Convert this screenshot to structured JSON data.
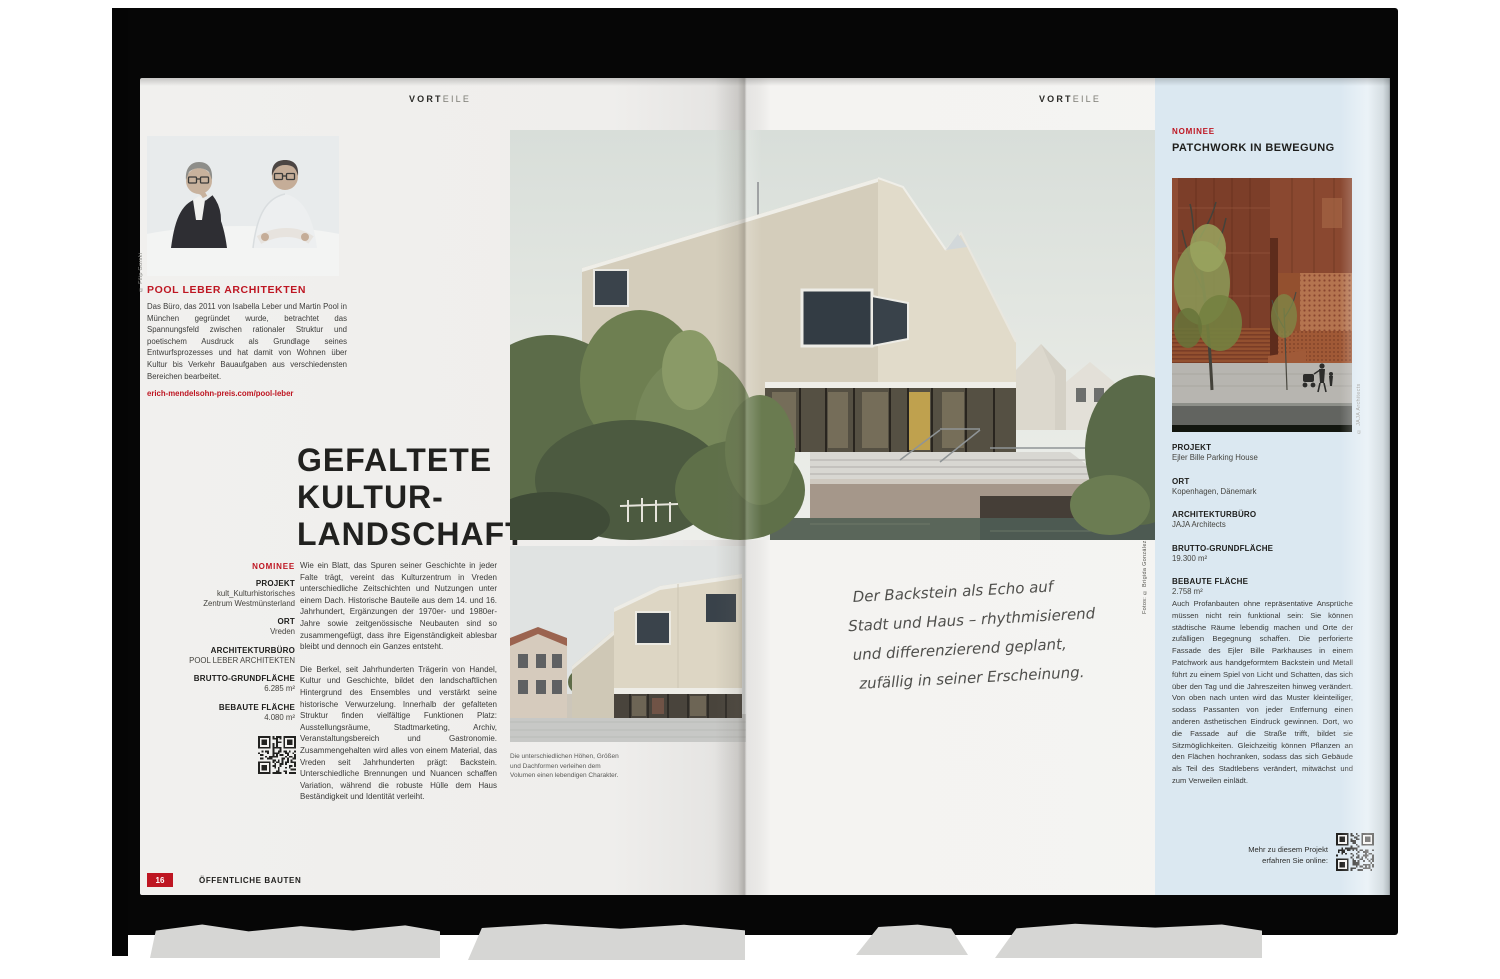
{
  "colors": {
    "accent_red": "#be1622",
    "sidebar_blue": "#dbe8f1"
  },
  "left_page": {
    "running_head_bold": "VORT",
    "running_head_light": "EILE",
    "photo_credit": "© Filip Gorski",
    "studio_heading": "POOL LEBER ARCHITEKTEN",
    "studio_text": "Das Büro, das 2011 von Isabella Leber und Martin Pool in München gegründet wurde, betrachtet das Spannungsfeld zwischen rationaler Struktur und poetischem Ausdruck als Grundlage seines Entwurfsprozesses und hat damit von Wohnen über Kultur bis Verkehr Bauaufgaben aus verschiedensten Bereichen bearbeitet.",
    "studio_link": "erich-mendelsohn-preis.com/pool-leber",
    "title_line1": "GEFALTETE",
    "title_line2": "KULTUR-",
    "title_line3": "LANDSCHAFT",
    "nominee_label": "NOMINEE",
    "facts": [
      {
        "label": "PROJEKT",
        "value": "kult_Kulturhistorisches\nZentrum Westmünsterland"
      },
      {
        "label": "ORT",
        "value": "Vreden"
      },
      {
        "label": "ARCHITEKTURBÜRO",
        "value": "POOL LEBER ARCHITEKTEN"
      },
      {
        "label": "BRUTTO-GRUNDFLÄCHE",
        "value": "6.285 m²"
      },
      {
        "label": "BEBAUTE FLÄCHE",
        "value": "4.080 m²"
      }
    ],
    "body_paragraph_1": "Wie ein Blatt, das Spuren seiner Geschichte in jeder Falte trägt, vereint das Kulturzentrum in Vreden unterschiedliche Zeitschichten und Nutzungen unter einem Dach. Historische Bauteile aus dem 14. und 16. Jahrhundert, Ergänzungen der 1970er- und 1980er-Jahre sowie zeitgenössische Neubauten sind so zusammengefügt, dass ihre Eigenständigkeit ablesbar bleibt und dennoch ein Ganzes entsteht.",
    "body_paragraph_2": "Die Berkel, seit Jahrhunderten Trägerin von Handel, Kultur und Geschichte, bildet den landschaftlichen Hintergrund des Ensembles und verstärkt seine historische Verwurzelung. Innerhalb der gefalteten Struktur finden vielfältige Funktionen Platz: Ausstellungsräume, Stadtmarketing, Archiv, Veranstaltungsbereich und Gastronomie. Zusammengehalten wird alles von einem Material, das Vreden seit Jahrhunderten prägt: Backstein. Unterschiedliche Brennungen und Nuancen schaffen Variation, während die robuste Hülle dem Haus Beständigkeit und Identität verleiht.",
    "page_number": "16",
    "footer_section": "ÖFFENTLICHE BAUTEN"
  },
  "center": {
    "photo_credit": "Fotos: © Brigida González",
    "caption": "Die unterschiedlichen Höhen, Größen\nund Dachformen verleihen dem\nVolumen einen lebendigen Charakter.",
    "handwriting_line1": "Der Backstein als Echo auf",
    "handwriting_line2": "Stadt und Haus – rhythmisierend",
    "handwriting_line3": "und differenzierend geplant,",
    "handwriting_line4": "zufällig in seiner Erscheinung."
  },
  "right_page": {
    "running_head_bold": "VORT",
    "running_head_light": "EILE",
    "nominee_label": "NOMINEE",
    "title": "PATCHWORK IN BEWEGUNG",
    "photo_credit": "© JAJA Architects",
    "facts": [
      {
        "label": "PROJEKT",
        "value": "Ejler Bille Parking House"
      },
      {
        "label": "ORT",
        "value": "Kopenhagen, Dänemark"
      },
      {
        "label": "ARCHITEKTURBÜRO",
        "value": "JAJA Architects"
      },
      {
        "label": "BRUTTO-GRUNDFLÄCHE",
        "value": "19.300 m²"
      },
      {
        "label": "BEBAUTE FLÄCHE",
        "value": "2.758 m²"
      }
    ],
    "body": "Auch Profanbauten ohne repräsentative Ansprüche müssen nicht rein funktional sein: Sie können städtische Räume lebendig machen und Orte der zufälligen Begegnung schaffen. Die perforierte Fassade des Ejler Bille Parkhauses in einem Patchwork aus handgeformtem Backstein und Metall führt zu einem Spiel von Licht und Schatten, das sich über den Tag und die Jahreszeiten hinweg verändert. Von oben nach unten wird das Muster kleinteiliger, sodass Passanten von jeder Entfernung einen anderen ästhetischen Eindruck gewinnen. Dort, wo die Fassade auf die Straße trifft, bildet sie Sitzmöglichkeiten. Gleichzeitig können Pflanzen an den Flächen hochranken, sodass das sich Gebäude als Teil des Stadtlebens verändert, mitwächst und zum Verweilen einlädt.",
    "qr_hint": "Mehr zu diesem Projekt\nerfahren Sie online:"
  }
}
